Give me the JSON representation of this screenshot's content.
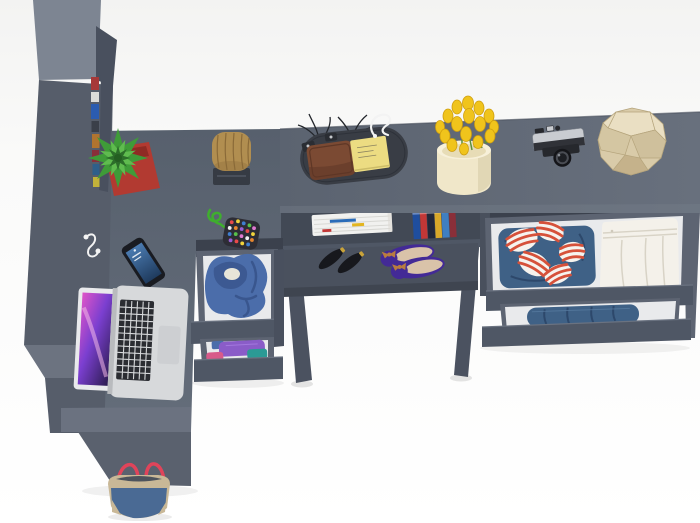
{
  "scene": {
    "label": "Top-down 3D product render of a graphite-gray corner desk and wardrobe set with open clothing drawers and desk accessories on a white floor",
    "objects": {
      "wardrobe": {
        "label": "Tall gray wardrobe column",
        "color": "#565d6a"
      },
      "wardrobeBooks": {
        "label": "Colorful book spines in wardrobe shelf gap"
      },
      "returnDesk": {
        "label": "Left desk return surface",
        "color": "#5b6370"
      },
      "topDesk": {
        "label": "Top horizontal desk surface",
        "color": "#5e6673"
      },
      "middleUnit": {
        "label": "Middle drawer unit with open drawers"
      },
      "rightUnit": {
        "label": "Right drawer unit with open drawers"
      },
      "shoeShelf": {
        "label": "Under-desk shoe shelf"
      },
      "plant": {
        "label": "Green fern plant in red square pot",
        "color": "#3f9b38"
      },
      "basket": {
        "label": "Wicker basket on dark mat",
        "color": "#b18e50"
      },
      "pouch": {
        "label": "Beaded pouch with green cord"
      },
      "phone": {
        "label": "Smartphone with blue screen"
      },
      "earphones": {
        "label": "White earphones"
      },
      "laptop": {
        "label": "Open silver laptop with pink wallpaper"
      },
      "tray": {
        "label": "Dark valet tray with accessories"
      },
      "wallet": {
        "label": "Brown leather wallet",
        "color": "#7b4a33"
      },
      "sticky": {
        "label": "Yellow sticky note pad",
        "color": "#ecdc82"
      },
      "branches": {
        "label": "Dark decorative twigs"
      },
      "wireDecor": {
        "label": "White wire ornament"
      },
      "vase": {
        "label": "Cream vase with yellow tulips",
        "color": "#f0c41c"
      },
      "camera": {
        "label": "Vintage silver camera"
      },
      "geoBall": {
        "label": "Beige faceted decor polyhedron",
        "color": "#d9cba9"
      },
      "magazines": {
        "label": "Stack of magazines on shelf"
      },
      "books": {
        "label": "Row of books on shelf"
      },
      "heels": {
        "label": "Black pointed high heels"
      },
      "flats": {
        "label": "Purple ballet flats with tan bows"
      },
      "jacket": {
        "label": "Blue denim jacket in open drawer"
      },
      "folded": {
        "label": "Folded purple and teal clothes in drawer"
      },
      "shirt": {
        "label": "Red striped shirt on jeans in open drawer"
      },
      "pants": {
        "label": "Folded white trousers in open drawer"
      },
      "jeans": {
        "label": "Rolled blue jeans in lower drawer"
      },
      "toteBag": {
        "label": "Beige and denim tote bag with red straps"
      }
    }
  },
  "colors": {
    "bg-top": "#f3f3f2",
    "panel-light": "#7d8592",
    "panel-mid": "#6c7380",
    "column": "#565d6a",
    "column-dark": "#49505e",
    "desk": "#5b6370",
    "desk-light": "#68707d",
    "desk-edge": "#78808c",
    "desk-back": "#49505d",
    "slab": "#6b7280",
    "slab-front": "#5a616e",
    "under-dark": "#3b414d",
    "shelf-inner": "#424955",
    "shoe-shelf": "#4a515e",
    "shelf-edge": "#3f4550",
    "leg": "#4b5260",
    "drawer-outer": "#5d6472",
    "drawer-front": "#4f5765",
    "drawer-interior": "#e9eaec",
    "pot-red": "#b23a31",
    "pot-dark": "#8f2b24",
    "leaf-dark": "#2c6e2a",
    "leaf-mid": "#3f9b38",
    "leaf-light": "#5fbb4f",
    "basket": "#b18e50",
    "basket-dark": "#8a6a38",
    "mat": "#363b44",
    "cord": "#3fae2e",
    "pouch": "#2d2d35",
    "phone-body": "#191b21",
    "phone-blue1": "#4a7ab0",
    "phone-blue2": "#1f3b5e",
    "bezel": "#e9eaec",
    "laptop-silver": "#d7d9db",
    "laptop-hinge": "#b9bbbe",
    "trackpad": "#cdcfd2",
    "key-black": "#2b2d32",
    "screen-pink": "#e055c8",
    "screen-violet": "#7b3fd0",
    "screen-deep": "#2c1c50",
    "tray": "#393d45",
    "wallet": "#7b4a33",
    "wallet-dark": "#5e3726",
    "sticky": "#ecdc82",
    "branch": "#23262c",
    "wire": "#f3f3f3",
    "vase": "#f0e7c9",
    "vase-light": "#f7f0d9",
    "vase-shade": "#ddd3b0",
    "tulip": "#f0c41c",
    "tulip-dark": "#cf9f10",
    "stem": "#5a8f3c",
    "camera-silver": "#c9ccd1",
    "camera-dark": "#26282d",
    "geo-light": "#eadfc3",
    "geo-mid": "#d9cba9",
    "geo-shade": "#cfc09c",
    "geo-dark": "#c5b28b",
    "geo-line": "#b5a47c",
    "magazine": "#f1f1ef",
    "mag-line": "#d8d8d4",
    "mag-blue": "#2b6cb8",
    "mag-yellow": "#e3b51f",
    "mag-red": "#c23736",
    "book1": "#1f4e9e",
    "book2": "#c23736",
    "book3": "#23283a",
    "book4": "#d9a82a",
    "book5": "#3f7fc1",
    "book6": "#8a2f39",
    "heel": "#17181d",
    "gold": "#c9a33a",
    "flat-purple": "#432a96",
    "insole": "#d9c3a9",
    "bow": "#b97c40",
    "shirt": "#f6f3ee",
    "stripe": "#d6513a",
    "jeans": "#3f6186",
    "jeans-dark": "#2d486b",
    "pants": "#f4f1ea",
    "pants-fold": "#d8d3c6",
    "jacket": "#4b6daa",
    "jacket-dark": "#39568e",
    "lining": "#e7e5d8",
    "fold-purple": "#8a5cc8",
    "fold-teal": "#2b9a95",
    "fold-pink": "#d85a8a",
    "tote": "#c9b897",
    "tote-denim": "#4a6a94",
    "strap": "#e0445a"
  }
}
